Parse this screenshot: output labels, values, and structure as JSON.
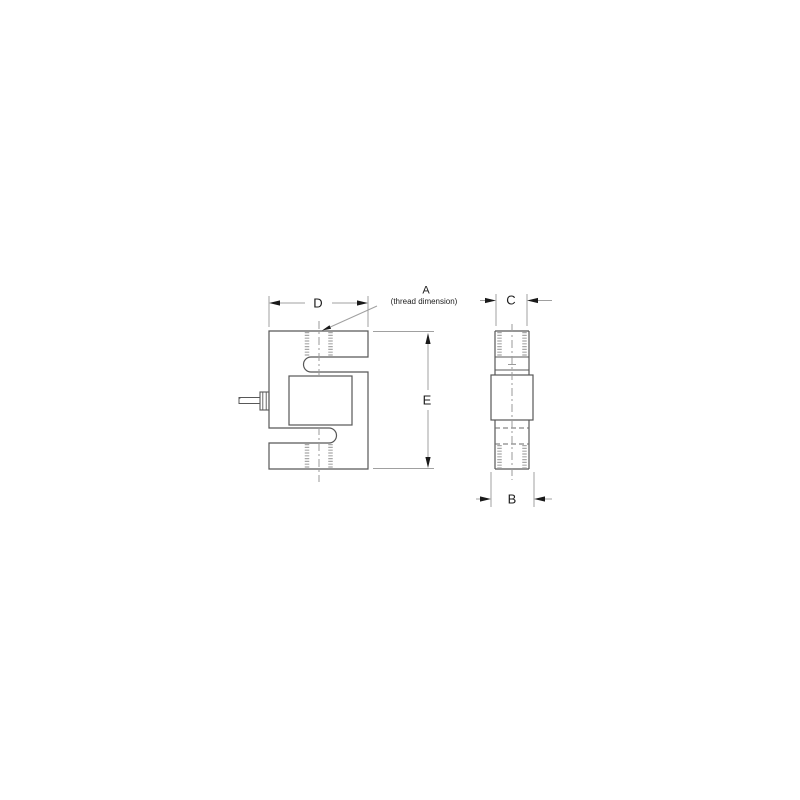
{
  "figure": {
    "type": "technical-dimension-drawing",
    "subject": "s-type-load-cell",
    "background": "#ffffff",
    "outline_color": "#585858",
    "dim_line_color": "#a0a0a0",
    "arrow_color": "#1a1a1a",
    "thread_color": "#a8a8a8",
    "centerline_color": "#9a9a9a",
    "hidden_line_color": "#6a6a6a",
    "text_color": "#1c1c1c",
    "labels": {
      "dim_d": "D",
      "dim_a": "A",
      "dim_a_note": "(thread dimension)",
      "dim_e": "E",
      "dim_c": "C",
      "dim_b": "B"
    }
  }
}
